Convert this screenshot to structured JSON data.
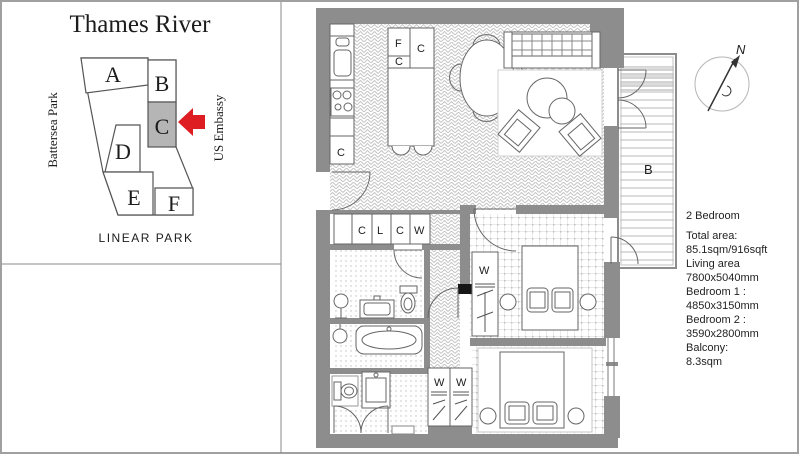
{
  "site_map": {
    "title": "Thames River",
    "blocks": [
      "A",
      "B",
      "C",
      "D",
      "E",
      "F"
    ],
    "left_label": "Battersea Park",
    "right_label": "US Embassy",
    "bottom_label": "LINEAR PARK"
  },
  "floor_plan": {
    "counter_label": "C",
    "island_labels": [
      "F",
      "C",
      "C"
    ],
    "closet_labels": [
      "C",
      "L",
      "C",
      "W"
    ],
    "bedroom1_wardrobe": "W",
    "bedroom2_wardrobes": [
      "W",
      "W"
    ],
    "balcony_label": "B",
    "compass_north": "N"
  },
  "info_panel": {
    "lines": [
      "2 Bedroom",
      "Total area:",
      "85.1sqm/916sqft",
      "Living area",
      "7800x5040mm",
      "Bedroom 1 :",
      "4850x3150mm",
      "Bedroom 2 :",
      "3590x2800mm",
      "Balcony:",
      "8.3sqm"
    ]
  },
  "colors": {
    "wall": "#8d8d8d",
    "highlight_block": "#b5b5b5",
    "arrow_red": "#dd1d21"
  }
}
